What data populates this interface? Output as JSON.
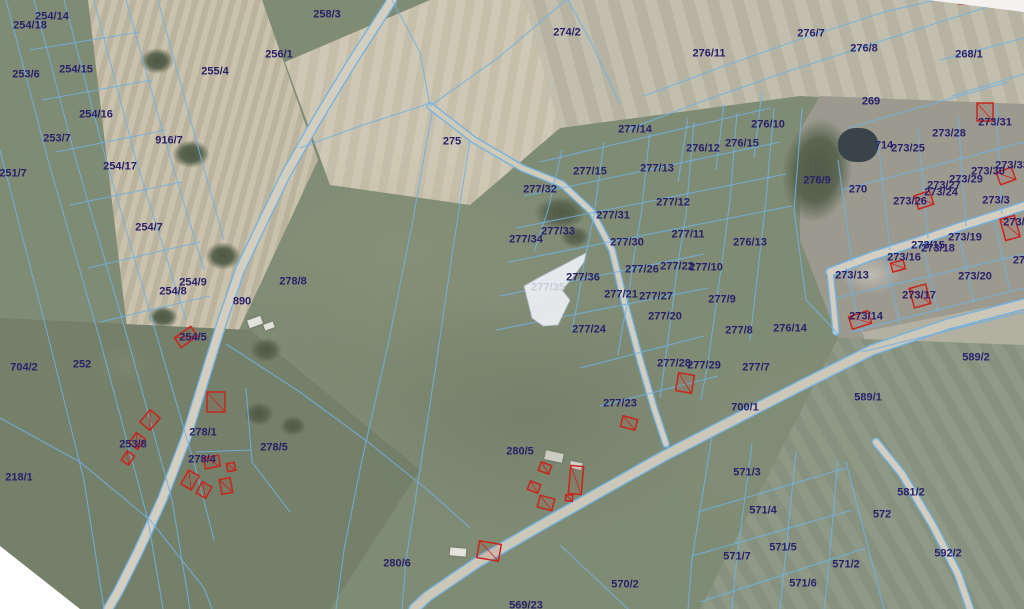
{
  "map": {
    "colors": {
      "label": "#29216b",
      "muted_label": "#c7cdd6",
      "boundary": "#70b2e4",
      "building": "#c8251d",
      "road": "#d4cec0",
      "road_main": "#cbc7b9",
      "selection_fill": "#e9ecef"
    },
    "selected_parcel": {
      "label": "277/35",
      "points": "586,253 540,277 524,286 532,318 543,326 558,325 570,300 562,290 574,276 584,262"
    },
    "roads": [
      {
        "name": "road-890",
        "points": "392,0 352,62 318,118 285,176 258,232 240,270 222,322 204,380 186,438 162,500 138,552 118,592 108,609",
        "width": 8
      },
      {
        "name": "main-road",
        "points": "1024,304 948,324 872,350 800,386 726,424 664,456 600,492 540,526 478,562 428,596 414,609",
        "width": 9,
        "color": "#cbc7b9"
      },
      {
        "name": "branch-road-southeast",
        "points": "876,442 902,474 932,524 958,574 970,609",
        "width": 6
      },
      {
        "name": "village-road",
        "points": "830,272 872,256 916,242 962,226 1006,212 1024,206",
        "width": 7
      },
      {
        "name": "village-connector",
        "points": "836,332 833,300 830,272",
        "width": 5
      },
      {
        "name": "center-lane",
        "points": "562,184 592,212 612,250 624,300 640,360 654,408 666,444",
        "width": 5
      },
      {
        "name": "dirt-lane",
        "points": "430,106 474,140 522,168 562,184",
        "width": 5,
        "color": "#d0cab8"
      }
    ],
    "boundaries": [
      "6,0 48,160 100,340 148,520 163,609",
      "34,0 76,160 128,340 172,500 190,609",
      "64,0 106,160 158,340 196,470 214,540",
      "94,0 136,160 186,320",
      "126,0 168,150 204,270",
      "158,0 196,140 224,240",
      "30,50 140,32",
      "42,100 152,80",
      "56,152 166,130",
      "70,205 182,182",
      "88,268 200,242",
      "100,322 210,296",
      "0,150 44,320 84,480 104,609",
      "0,418 80,462 150,520 204,588 212,609",
      "392,0 420,52 430,106",
      "300,148 360,126 428,104",
      "566,0 498,58 430,106",
      "620,104 592,44 568,0",
      "432,112 412,225 388,345 362,460 344,550 336,609",
      "470,140 452,255 436,365 420,470 406,560 402,609",
      "226,344 300,392 368,442 430,492 470,528",
      "246,388 252,462 290,512",
      "196,452 250,450",
      "562,150 548,210 534,252",
      "604,142 594,215 585,258 578,300 572,330",
      "650,132 641,215 633,262 628,300 622,330 618,355",
      "694,122 686,215 678,262 672,310 666,355 660,398",
      "737,113 730,200 722,262 714,320 708,362 701,400",
      "774,108 766,200 758,270 750,340",
      "540,162 770,108",
      "524,196 780,142",
      "516,228 786,174",
      "508,262 792,206",
      "500,296 704,254",
      "496,330 708,288",
      "580,368 704,336",
      "600,406 718,376",
      "644,96 724,66 804,38 884,12 936,0",
      "626,130 706,100 786,72 866,46 946,20 1010,0",
      "688,118 678,182",
      "724,104 716,170",
      "762,92 754,158",
      "802,108 794,210 806,300 838,334",
      "940,60 1024,38",
      "952,96 1024,74",
      "846,268 862,332",
      "884,256 900,324",
      "922,243 938,312",
      "958,232 974,302",
      "994,220 1010,290",
      "836,298 1024,254",
      "850,332 1024,288",
      "852,262 838,160",
      "890,250 878,140",
      "928,238 918,128",
      "966,226 958,116",
      "1002,214 996,104",
      "842,190 1024,142",
      "848,128 1008,82",
      "862,352 1024,312",
      "712,436 692,560 688,609",
      "752,444 736,565 732,609",
      "796,452 783,580 780,609",
      "838,460 827,585 824,609",
      "698,512 846,468",
      "692,556 852,510",
      "700,602 866,548",
      "846,462 884,609",
      "560,545 628,609"
    ],
    "buildings": [
      [
        985,
        112,
        16,
        18,
        0
      ],
      [
        1006,
        176,
        16,
        13,
        -20
      ],
      [
        1010,
        228,
        15,
        22,
        -15
      ],
      [
        924,
        200,
        16,
        14,
        -18
      ],
      [
        898,
        266,
        13,
        9,
        -15
      ],
      [
        920,
        296,
        17,
        20,
        -15
      ],
      [
        860,
        320,
        20,
        13,
        -18
      ],
      [
        967,
        0,
        16,
        8,
        0
      ],
      [
        216,
        402,
        18,
        20,
        0
      ],
      [
        150,
        420,
        13,
        16,
        40
      ],
      [
        137,
        441,
        11,
        13,
        35
      ],
      [
        128,
        458,
        9,
        11,
        35
      ],
      [
        212,
        462,
        15,
        11,
        -10
      ],
      [
        231,
        467,
        8,
        8,
        -10
      ],
      [
        190,
        480,
        12,
        16,
        30
      ],
      [
        204,
        490,
        11,
        13,
        30
      ],
      [
        226,
        486,
        11,
        15,
        -10
      ],
      [
        186,
        337,
        20,
        12,
        -35
      ],
      [
        545,
        468,
        11,
        9,
        20
      ],
      [
        534,
        487,
        11,
        9,
        20
      ],
      [
        546,
        503,
        15,
        12,
        15
      ],
      [
        576,
        480,
        13,
        28,
        5
      ],
      [
        569,
        498,
        7,
        6,
        5
      ],
      [
        489,
        551,
        22,
        17,
        10
      ],
      [
        629,
        423,
        15,
        11,
        15
      ],
      [
        685,
        383,
        16,
        18,
        10
      ]
    ],
    "parcel_labels": [
      {
        "text": "254/14",
        "x": 52,
        "y": 17
      },
      {
        "text": "254/18",
        "x": 30,
        "y": 26
      },
      {
        "text": "253/6",
        "x": 26,
        "y": 75
      },
      {
        "text": "254/15",
        "x": 76,
        "y": 70
      },
      {
        "text": "254/16",
        "x": 96,
        "y": 115
      },
      {
        "text": "253/7",
        "x": 57,
        "y": 139
      },
      {
        "text": "916/7",
        "x": 169,
        "y": 141
      },
      {
        "text": "251/7",
        "x": 13,
        "y": 174
      },
      {
        "text": "254/17",
        "x": 120,
        "y": 167
      },
      {
        "text": "254/7",
        "x": 149,
        "y": 228
      },
      {
        "text": "258/3",
        "x": 327,
        "y": 15
      },
      {
        "text": "256/1",
        "x": 279,
        "y": 55
      },
      {
        "text": "255/4",
        "x": 215,
        "y": 72
      },
      {
        "text": "274/2",
        "x": 567,
        "y": 33
      },
      {
        "text": "275",
        "x": 452,
        "y": 142
      },
      {
        "text": "276/11",
        "x": 709,
        "y": 54
      },
      {
        "text": "276/7",
        "x": 811,
        "y": 34
      },
      {
        "text": "276/8",
        "x": 864,
        "y": 49
      },
      {
        "text": "268/1",
        "x": 969,
        "y": 55
      },
      {
        "text": "269",
        "x": 871,
        "y": 102
      },
      {
        "text": "277/14",
        "x": 635,
        "y": 130
      },
      {
        "text": "277/15",
        "x": 590,
        "y": 172
      },
      {
        "text": "277/13",
        "x": 657,
        "y": 169
      },
      {
        "text": "276/10",
        "x": 768,
        "y": 125
      },
      {
        "text": "276/15",
        "x": 742,
        "y": 144
      },
      {
        "text": "276/12",
        "x": 703,
        "y": 149
      },
      {
        "text": "276/9",
        "x": 817,
        "y": 181
      },
      {
        "text": "270",
        "x": 858,
        "y": 190
      },
      {
        "text": "714",
        "x": 884,
        "y": 146
      },
      {
        "text": "273/25",
        "x": 908,
        "y": 149
      },
      {
        "text": "273/28",
        "x": 949,
        "y": 134
      },
      {
        "text": "273/31",
        "x": 995,
        "y": 123
      },
      {
        "text": "273/33",
        "x": 1012,
        "y": 166
      },
      {
        "text": "273/30",
        "x": 988,
        "y": 172
      },
      {
        "text": "273/29",
        "x": 966,
        "y": 180
      },
      {
        "text": "273/27",
        "x": 944,
        "y": 186
      },
      {
        "text": "273/24",
        "x": 941,
        "y": 193
      },
      {
        "text": "273/26",
        "x": 910,
        "y": 202
      },
      {
        "text": "273/3",
        "x": 996,
        "y": 201
      },
      {
        "text": "273/2",
        "x": 1017,
        "y": 223
      },
      {
        "text": "277/32",
        "x": 540,
        "y": 190
      },
      {
        "text": "277/31",
        "x": 613,
        "y": 216
      },
      {
        "text": "277/30",
        "x": 627,
        "y": 243
      },
      {
        "text": "277/33",
        "x": 558,
        "y": 232
      },
      {
        "text": "277/34",
        "x": 526,
        "y": 240
      },
      {
        "text": "277/12",
        "x": 673,
        "y": 203
      },
      {
        "text": "277/11",
        "x": 688,
        "y": 235
      },
      {
        "text": "276/13",
        "x": 750,
        "y": 243
      },
      {
        "text": "277/22",
        "x": 677,
        "y": 267
      },
      {
        "text": "277/10",
        "x": 706,
        "y": 268
      },
      {
        "text": "277/26",
        "x": 642,
        "y": 270
      },
      {
        "text": "277/36",
        "x": 583,
        "y": 278
      },
      {
        "text": "277/35",
        "x": 548,
        "y": 288,
        "muted": true
      },
      {
        "text": "277/21",
        "x": 621,
        "y": 295
      },
      {
        "text": "277/27",
        "x": 656,
        "y": 297
      },
      {
        "text": "277/9",
        "x": 722,
        "y": 300
      },
      {
        "text": "277/20",
        "x": 665,
        "y": 317
      },
      {
        "text": "277/24",
        "x": 589,
        "y": 330
      },
      {
        "text": "277/8",
        "x": 739,
        "y": 331
      },
      {
        "text": "276/14",
        "x": 790,
        "y": 329
      },
      {
        "text": "273/13",
        "x": 852,
        "y": 276
      },
      {
        "text": "273/16",
        "x": 904,
        "y": 258
      },
      {
        "text": "273/15",
        "x": 928,
        "y": 246
      },
      {
        "text": "273/18",
        "x": 938,
        "y": 249
      },
      {
        "text": "273/19",
        "x": 965,
        "y": 238
      },
      {
        "text": "273/20",
        "x": 975,
        "y": 277
      },
      {
        "text": "27",
        "x": 1019,
        "y": 261
      },
      {
        "text": "273/17",
        "x": 919,
        "y": 296
      },
      {
        "text": "273/14",
        "x": 866,
        "y": 317
      },
      {
        "text": "589/2",
        "x": 976,
        "y": 358
      },
      {
        "text": "589/1",
        "x": 868,
        "y": 398
      },
      {
        "text": "277/28",
        "x": 674,
        "y": 364
      },
      {
        "text": "277/29",
        "x": 704,
        "y": 366
      },
      {
        "text": "277/7",
        "x": 756,
        "y": 368
      },
      {
        "text": "700/1",
        "x": 745,
        "y": 408
      },
      {
        "text": "277/23",
        "x": 620,
        "y": 404
      },
      {
        "text": "278/8",
        "x": 293,
        "y": 282
      },
      {
        "text": "890",
        "x": 242,
        "y": 302
      },
      {
        "text": "254/9",
        "x": 193,
        "y": 283
      },
      {
        "text": "254/8",
        "x": 173,
        "y": 292
      },
      {
        "text": "254/5",
        "x": 193,
        "y": 338
      },
      {
        "text": "252",
        "x": 82,
        "y": 365
      },
      {
        "text": "704/2",
        "x": 24,
        "y": 368
      },
      {
        "text": "218/1",
        "x": 19,
        "y": 478
      },
      {
        "text": "253/8",
        "x": 133,
        "y": 445
      },
      {
        "text": "278/1",
        "x": 203,
        "y": 433
      },
      {
        "text": "278/4",
        "x": 202,
        "y": 460
      },
      {
        "text": "278/5",
        "x": 274,
        "y": 448
      },
      {
        "text": "280/5",
        "x": 520,
        "y": 452
      },
      {
        "text": "280/6",
        "x": 397,
        "y": 564
      },
      {
        "text": "570/2",
        "x": 625,
        "y": 585
      },
      {
        "text": "569/23",
        "x": 526,
        "y": 606
      },
      {
        "text": "571/3",
        "x": 747,
        "y": 473
      },
      {
        "text": "571/4",
        "x": 763,
        "y": 511
      },
      {
        "text": "571/5",
        "x": 783,
        "y": 548
      },
      {
        "text": "571/7",
        "x": 737,
        "y": 557
      },
      {
        "text": "571/2",
        "x": 846,
        "y": 565
      },
      {
        "text": "571/6",
        "x": 803,
        "y": 584
      },
      {
        "text": "572",
        "x": 882,
        "y": 515
      },
      {
        "text": "581/2",
        "x": 911,
        "y": 493
      },
      {
        "text": "592/2",
        "x": 948,
        "y": 554
      }
    ]
  }
}
